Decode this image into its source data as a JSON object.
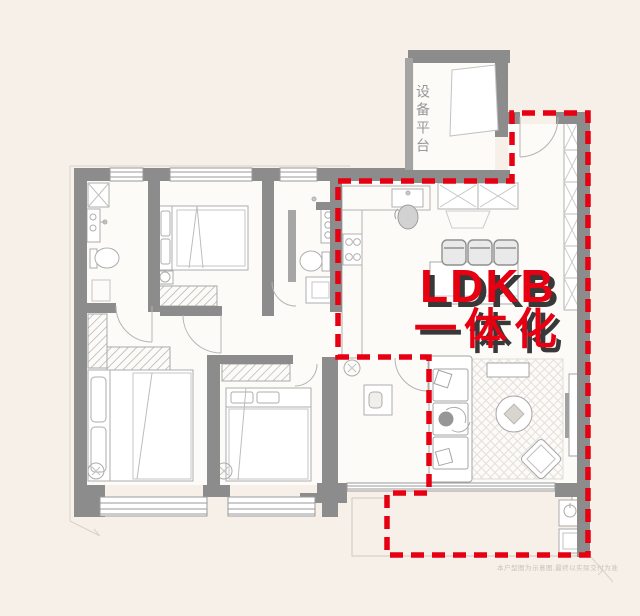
{
  "overlay": {
    "line1": "LDKB",
    "line2": "一体化"
  },
  "platform": {
    "label": "设备平台"
  },
  "watermark": {
    "text": "本户型图为示意图,最终以实际交付为准"
  },
  "colors": {
    "background": "#f6f0e9",
    "floor": "#fdfbf8",
    "wall_gray": "#8c8c8c",
    "furniture_line": "#b0b0b0",
    "highlight_red": "#e60012",
    "text_shadow": "#383838"
  }
}
